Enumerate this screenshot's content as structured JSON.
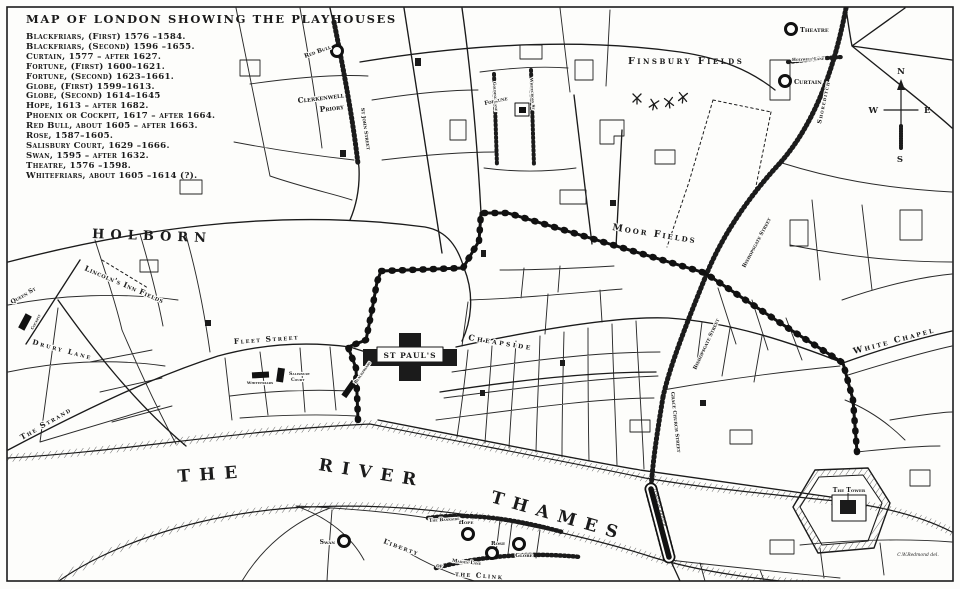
{
  "title": "MAP OF LONDON SHOWING THE PLAYHOUSES",
  "colors": {
    "ink": "#1b1b1b",
    "paper": "#fdfdfb"
  },
  "legend": {
    "entries": [
      "Blackfriars, (First) 1576 –1584.",
      "Blackfriars, (Second) 1596 –1655.",
      "Curtain, 1577 – after 1627.",
      "Fortune, (First) 1600–1621.",
      "Fortune, (Second) 1623–1661.",
      "Globe, (First) 1599–1613.",
      "Globe, (Second) 1614–1645",
      "Hope, 1613 – after 1682.",
      "Phoenix or Cockpit, 1617 – after 1664.",
      "Red Bull, about 1605 – after 1663.",
      "Rose, 1587–1605.",
      "Salisbury Court, 1629 –1666.",
      "Swan, 1595 – after 1632.",
      "Theatre, 1576 –1598.",
      "Whitefriars, about 1605 –1614 (?)."
    ]
  },
  "compass": {
    "n": "N",
    "e": "E",
    "s": "S",
    "w": "W"
  },
  "river": {
    "w1": "THE",
    "w2": "RIVER",
    "w3": "THAMES"
  },
  "places": {
    "finsbury": "Finsbury Fields",
    "moor": "Moor Fields",
    "lincolns": "Lincoln's Inn Fields",
    "clerkenwell_1": "Clerkenwell",
    "clerkenwell_2": "Priory",
    "st_pauls": "ST PAUL'S",
    "tower": "The Tower",
    "liberty_1": "Liberty",
    "liberty_2": "of",
    "liberty_3": "the Clink",
    "white_chapel": "White Chapel"
  },
  "streets": {
    "holborn": "HOLBORN",
    "strand": "The Strand",
    "fleet": "Fleet Street",
    "drury": "Drury Lane",
    "queen": "Queen St",
    "cheapside": "Cheapside",
    "bishopsgate": "Bishopsgate Street",
    "gracechurch": "Grace Church Street",
    "shoreditch": "Shoreditch",
    "holywell": "Holywell Lane",
    "st_john": "St John Street",
    "golding": "Golding Lane",
    "whitecross": "Whitecross St",
    "bankside": "The Bankside",
    "maiden": "Maiden Lane",
    "london_bridge": "LONDON BRIDGE"
  },
  "markers": {
    "theatre": "Theatre",
    "curtain": "Curtain",
    "red_bull": "Red Bull",
    "fortune": "Fortune",
    "swan": "Swan",
    "hope": "Hope",
    "rose": "Rose",
    "globe": "Globe",
    "whitefriars": "Whitefriars",
    "salisbury_1": "Salisbury",
    "salisbury_2": "Court",
    "blackfriars": "Blackfriars",
    "cockpit": "Cockpit"
  },
  "signature": "C.W.Redmond del."
}
